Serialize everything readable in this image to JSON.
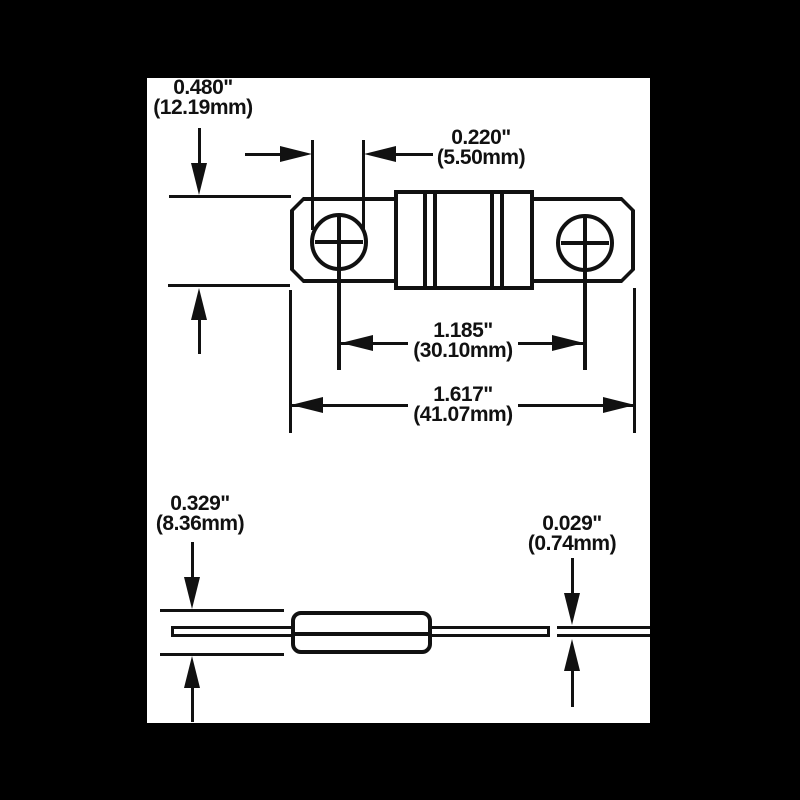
{
  "colors": {
    "background": "#000000",
    "canvas": "#ffffff",
    "line": "#111111"
  },
  "dim": {
    "plate_height": {
      "inch": "0.480\"",
      "mm": "(12.19mm)"
    },
    "hole_diameter": {
      "inch": "0.220\"",
      "mm": "(5.50mm)"
    },
    "hole_spacing": {
      "inch": "1.185\"",
      "mm": "(30.10mm)"
    },
    "overall_length": {
      "inch": "1.617\"",
      "mm": "(41.07mm)"
    },
    "body_height": {
      "inch": "0.329\"",
      "mm": "(8.36mm)"
    },
    "tab_thickness": {
      "inch": "0.029\"",
      "mm": "(0.74mm)"
    }
  }
}
